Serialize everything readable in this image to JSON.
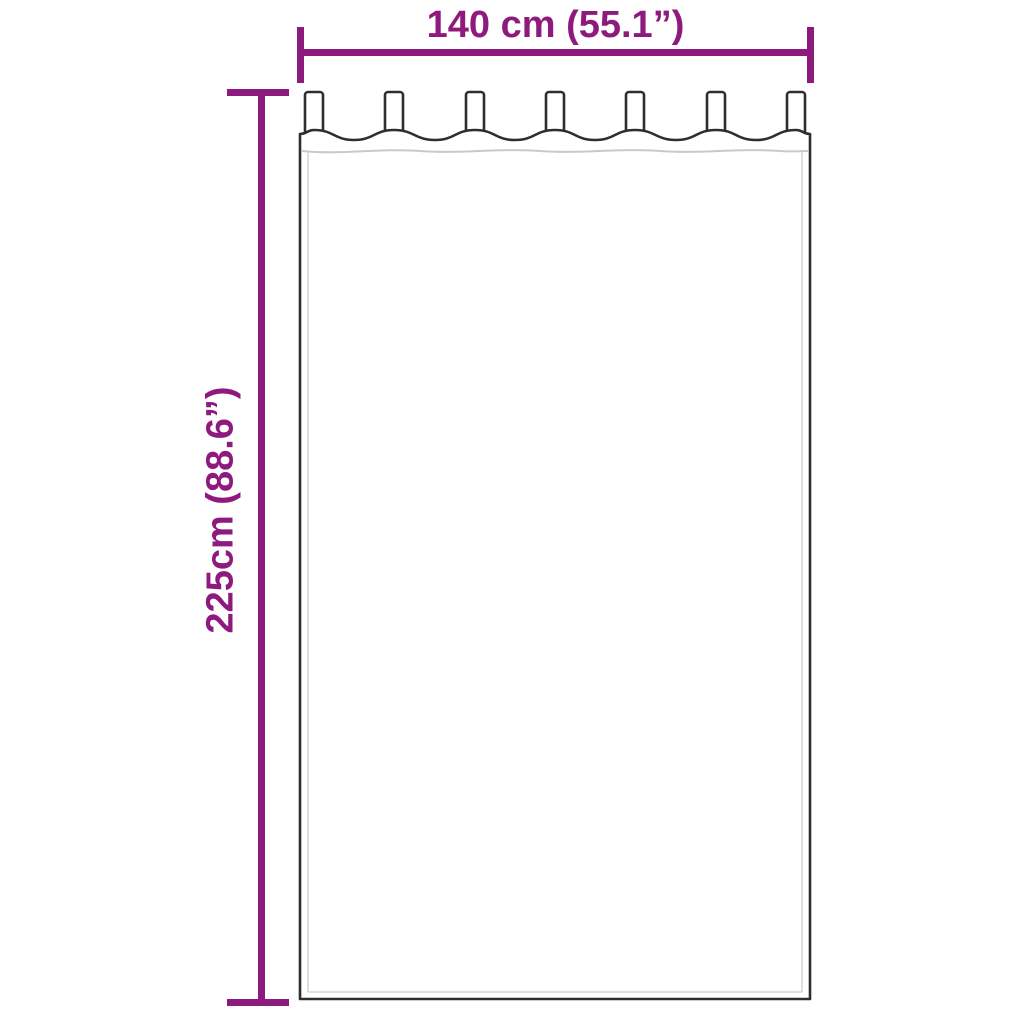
{
  "diagram": {
    "background_color": "#ffffff",
    "accent_color": "#8e1a7e",
    "outline_color": "#2e2e2e",
    "inner_line_color": "#c9c9c9",
    "tab_count": 7
  },
  "dimensions": {
    "width": {
      "label": "140 cm (55.1”)"
    },
    "height": {
      "label": "225cm (88.6”)"
    }
  }
}
